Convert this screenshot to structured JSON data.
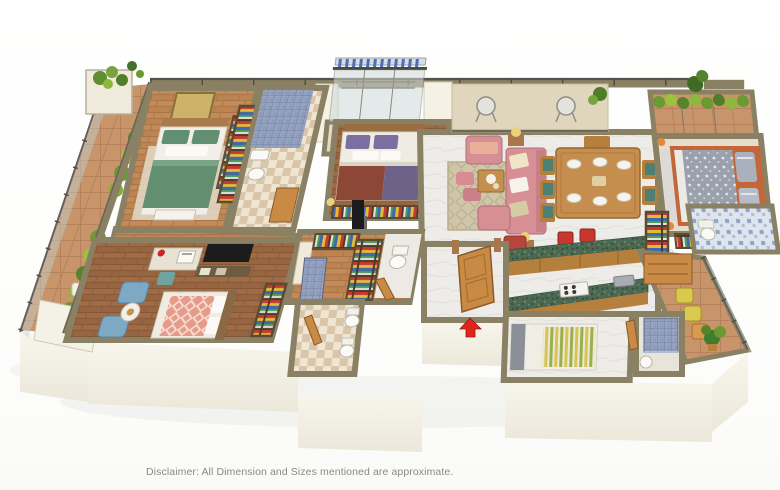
{
  "disclaimer": "Disclaimer: All Dimension and Sizes mentioned are approximate.",
  "palette": {
    "background": "#ffffff",
    "wall_top": "#8a8164",
    "wall_edge": "#55524a",
    "wall_face": "#f5f1e4",
    "wood": "#c28b57",
    "wood_dark": "#a06c45",
    "terracotta": "#c8946a",
    "marble": "#edece8",
    "tile_blue": "#8e9cbd",
    "mosaic_blue": "#dfe5ee",
    "granite_green": "#4c6a52",
    "cabinet_wood": "#b5803e",
    "door_wood": "#c98a45",
    "sofa_pink": "#d78f96",
    "accent_red": "#b8453c",
    "arrow_red": "#e0241c",
    "bed_green": "#628f6f",
    "bed_purple": "#6e6288",
    "bed_maroon": "#8c4736",
    "bed_grey": "#9aa0ac",
    "chair_blue": "#7da9c4",
    "chair_teal": "#4e7f72",
    "chair_yellow": "#d9c94e",
    "lamp_gold": "#ead27c",
    "hedge_green": "#6a9a33",
    "hedge_light": "#9cc23e",
    "rug_beige": "#cfc6a9",
    "text_grey": "#898989"
  },
  "scene": {
    "type": "3d-isometric-floor-plan",
    "subject": "apartment cutaway 3D render",
    "entry_marker": "red-up-arrow",
    "rooms": [
      {
        "id": "balcony-left",
        "floor": "terracotta-tile",
        "features": [
          "glass-railing",
          "shrub-planters",
          "corner-planter",
          "lounge-chair"
        ]
      },
      {
        "id": "bedroom-1",
        "floor": "wood",
        "features": [
          "double-bed-green-bedding",
          "wall-art",
          "wardrobe-open-shelves",
          "bench",
          "rug"
        ]
      },
      {
        "id": "bathroom-1",
        "floor": "checker-tile",
        "features": [
          "blue-tiled-shower",
          "washbasin",
          "toilet"
        ]
      },
      {
        "id": "utility-balcony",
        "floor": "beige-tile",
        "features": [
          "clothes-drying-rack",
          "blue-railing-clips",
          "glass-wall"
        ]
      },
      {
        "id": "bedroom-2-master",
        "floor": "wood",
        "features": [
          "double-bed-purple-maroon-bedding",
          "wardrobe-open-shelves",
          "table-lamps",
          "wall-tv"
        ]
      },
      {
        "id": "walk-in-closet",
        "floor": "wood",
        "features": [
          "open-wardrobes-colorful-clothes",
          "toilet-nook"
        ]
      },
      {
        "id": "bathroom-2",
        "floor": "checker-tile",
        "features": [
          "two-toilets",
          "blue-tiled-shower",
          "wooden-door"
        ]
      },
      {
        "id": "living-balcony",
        "floor": "beige-tile",
        "features": [
          "two-wire-chairs",
          "potted-plant"
        ]
      },
      {
        "id": "living-room",
        "floor": "marble",
        "features": [
          "pink-sofa-set",
          "ottomans",
          "coffee-table",
          "area-rug",
          "lamp-side-tables",
          "red-accent-chair"
        ]
      },
      {
        "id": "dining-room",
        "floor": "marble",
        "features": [
          "six-seater-wooden-table",
          "teal-chairs",
          "place-settings"
        ]
      },
      {
        "id": "kitchen",
        "floor": "marble",
        "features": [
          "green-granite-counters",
          "wooden-cabinets",
          "hob",
          "sink",
          "fridge",
          "red-bar-stools"
        ]
      },
      {
        "id": "bedroom-3",
        "floor": "beige",
        "features": [
          "hedge-balcony",
          "double-bed-grey-floral-bedding",
          "orange-bed-frame",
          "wardrobe-open-shelves"
        ]
      },
      {
        "id": "bathroom-3",
        "floor": "blue-mosaic-tile",
        "features": [
          "toilet",
          "wardrobe-shelves"
        ]
      },
      {
        "id": "study-bedroom-4",
        "floor": "wood",
        "features": [
          "desk-with-computer",
          "red-desk-lamp",
          "tv-console",
          "two-blue-armchairs",
          "round-side-table",
          "salmon-diamond-bed",
          "wardrobe-open-shelves"
        ]
      },
      {
        "id": "foyer",
        "floor": "marble",
        "features": [
          "wooden-entry-door",
          "entry-arrow-marker"
        ]
      },
      {
        "id": "utility-bedroom",
        "floor": "marble",
        "features": [
          "single-bed-striped-bedding"
        ]
      },
      {
        "id": "bathroom-4",
        "floor": "tile",
        "features": [
          "blue-tiled-shower",
          "wash-bucket"
        ]
      },
      {
        "id": "balcony-right",
        "floor": "terracotta-tile",
        "features": [
          "wooden-dresser",
          "yellow-chairs",
          "orange-chair",
          "potted-plant",
          "glass-railing"
        ]
      }
    ]
  }
}
